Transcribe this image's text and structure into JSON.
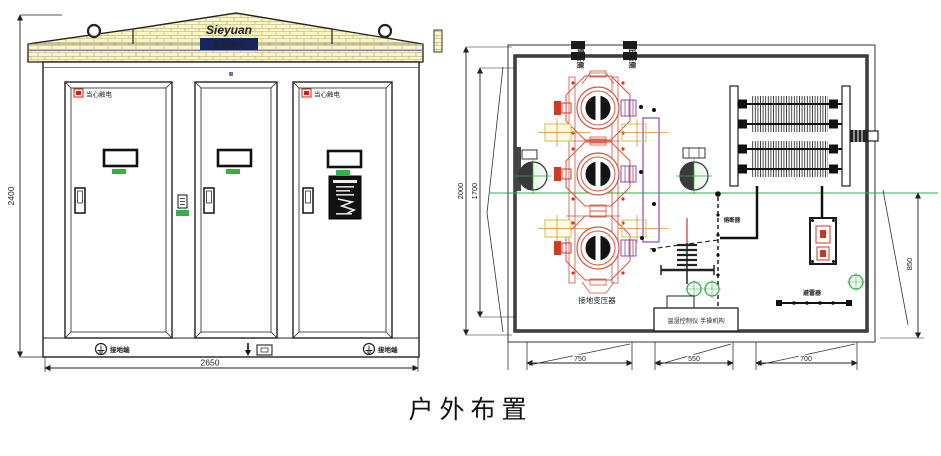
{
  "caption": "户外布置",
  "elevation": {
    "logo_line1": "Sieyuan",
    "logo_line2": "思源电气",
    "door_warning": "当心触电",
    "dim_height": "2400",
    "dim_width": "2650",
    "ground_left": "接地端",
    "ground_right": "接地端"
  },
  "plan": {
    "entry_left": "高压侧",
    "entry_right": "低压侧",
    "transformer_label": "接地变压器",
    "cable_label": "熔断器",
    "arrester_label": "避雷器",
    "controller_label": "温湿控制仪 手操机构",
    "dim_outer": "2000",
    "dim_inner": "1700",
    "dim_right": "850",
    "dim_bottom_1": "750",
    "dim_bottom_2": "550",
    "dim_bottom_3": "700"
  },
  "colors": {
    "roof_yellow": "#faf7c0",
    "brick_line": "#b3ab8f",
    "green": "#2fae44",
    "warning_red": "#cc2211",
    "transformer_red": "#d4543f",
    "purple": "#8a4ab0",
    "logo_navy": "#16265c",
    "line_black": "#222222"
  }
}
